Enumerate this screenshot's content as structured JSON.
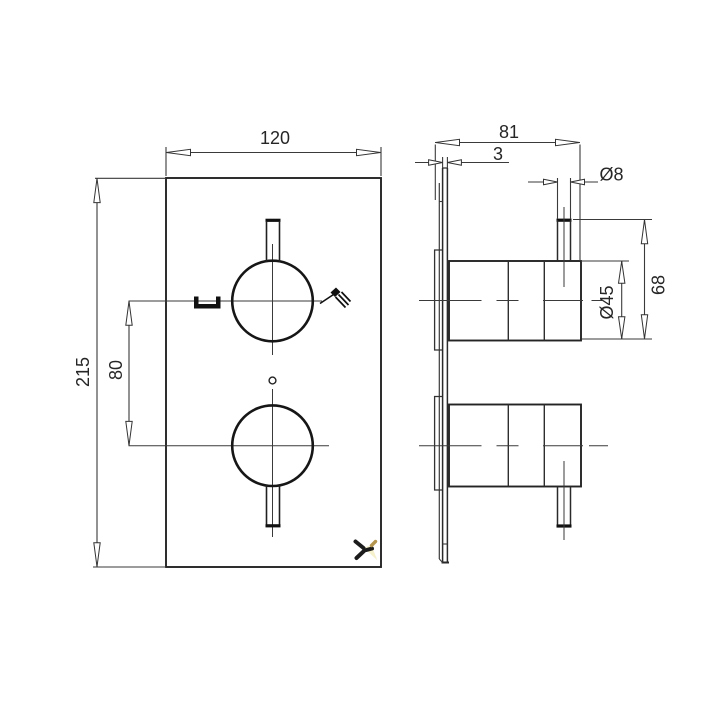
{
  "title": "thermostatic-shower-valve-dimension-drawing",
  "front": {
    "width_label": "120",
    "height_label": "215",
    "handle_spacing_label": "80"
  },
  "side": {
    "depth_label": "81",
    "plate_thickness_label": "3",
    "spindle_diameter_label": "Ø8",
    "projection_label": "68",
    "body_diameter_label": "Ø45"
  },
  "icons": {
    "bath_spout": "bath-spout-icon",
    "shower_spray": "shower-spray-icon",
    "setscrew": "setscrew-icon",
    "brand_logo": "brand-logo-icon"
  },
  "colors": {
    "background": "#ffffff",
    "line": "#333333",
    "outline": "#1a1a1a",
    "text": "#262626",
    "logo_black": "#1c1c1c",
    "logo_gold": "#b49550",
    "logo_pale_yellow": "#f5f1cd"
  }
}
